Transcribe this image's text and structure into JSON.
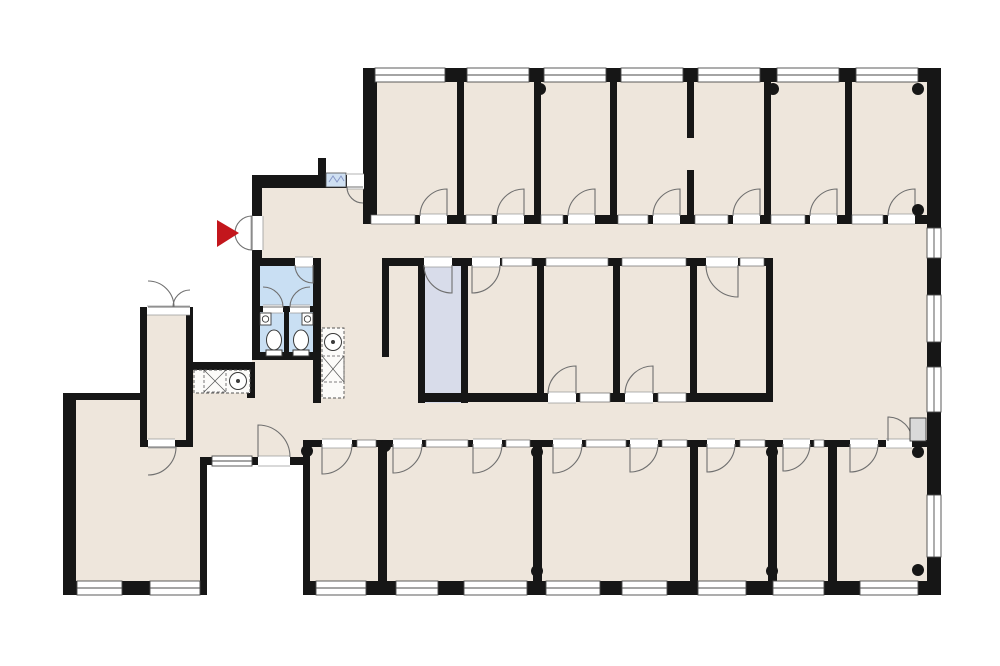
{
  "meta": {
    "description": "office-building-floor-plan",
    "canvas": {
      "w": 1000,
      "h": 666
    }
  },
  "palette": {
    "background": "#ffffff",
    "wall": "#161616",
    "room": "#EEE6DC",
    "bathroom": "#C9DFF3",
    "storage": "#D8DCEA",
    "entry_arrow": "#C3161C",
    "window_frame": "#4a4a4a",
    "interior_glass": "#6a6a6a",
    "threshold_line": "#9a9a9a",
    "door_line": "#6f6f6f",
    "fixture_line": "#3a3a3a",
    "fixture_fill": "#ffffff",
    "counter_line": "#555555",
    "mat_fill": "#d9d9d9",
    "glass_block_fill": "#cfe0f2",
    "glass_block_line": "#8898c8"
  },
  "floors": [
    {
      "name": "floor-top-rooms",
      "fill": "room",
      "rect": [
        363,
        68,
        564,
        198
      ]
    },
    {
      "name": "floor-entry-hall",
      "fill": "room",
      "rect": [
        252,
        175,
        125,
        265
      ]
    },
    {
      "name": "floor-corridor",
      "fill": "room",
      "rect": [
        377,
        228,
        550,
        212
      ]
    },
    {
      "name": "floor-left-lobby",
      "fill": "room",
      "rect": [
        193,
        362,
        117,
        95
      ]
    },
    {
      "name": "floor-kitchen",
      "fill": "room",
      "rect": [
        140,
        307,
        53,
        140
      ]
    },
    {
      "name": "floor-big-room",
      "fill": "room",
      "rect": [
        63,
        393,
        144,
        202
      ]
    },
    {
      "name": "floor-bottom-rooms",
      "fill": "room",
      "rect": [
        303,
        440,
        638,
        155
      ]
    },
    {
      "name": "floor-bathroom",
      "fill": "bathroom",
      "rect": [
        252,
        258,
        68,
        102
      ]
    },
    {
      "name": "floor-storage",
      "fill": "storage",
      "rect": [
        418,
        262,
        50,
        141
      ]
    }
  ],
  "walls": [
    [
      363,
      68,
      578,
      14
    ],
    [
      927,
      68,
      14,
      527
    ],
    [
      363,
      82,
      14,
      133
    ],
    [
      363,
      215,
      564,
      9
    ],
    [
      457,
      82,
      7,
      133
    ],
    [
      534,
      82,
      7,
      133
    ],
    [
      610,
      82,
      7,
      133
    ],
    [
      687,
      82,
      7,
      56
    ],
    [
      687,
      170,
      7,
      45
    ],
    [
      764,
      82,
      7,
      133
    ],
    [
      845,
      82,
      7,
      133
    ],
    [
      252,
      175,
      125,
      13
    ],
    [
      318,
      158,
      8,
      17
    ],
    [
      252,
      175,
      10,
      87
    ],
    [
      252,
      258,
      68,
      8
    ],
    [
      313,
      258,
      8,
      145
    ],
    [
      252,
      352,
      69,
      8
    ],
    [
      252,
      262,
      8,
      98
    ],
    [
      260,
      306,
      53,
      6
    ],
    [
      284,
      312,
      5,
      40
    ],
    [
      382,
      258,
      391,
      8
    ],
    [
      382,
      262,
      7,
      95
    ],
    [
      418,
      262,
      7,
      141
    ],
    [
      461,
      262,
      7,
      141
    ],
    [
      537,
      266,
      7,
      127
    ],
    [
      613,
      266,
      7,
      127
    ],
    [
      690,
      266,
      7,
      127
    ],
    [
      766,
      262,
      7,
      140
    ],
    [
      418,
      393,
      355,
      9
    ],
    [
      140,
      307,
      53,
      7
    ],
    [
      140,
      307,
      7,
      140
    ],
    [
      186,
      307,
      7,
      140
    ],
    [
      140,
      440,
      53,
      7
    ],
    [
      193,
      362,
      62,
      8
    ],
    [
      247,
      370,
      8,
      28
    ],
    [
      63,
      393,
      84,
      7
    ],
    [
      63,
      393,
      13,
      202
    ],
    [
      200,
      457,
      7,
      124
    ],
    [
      200,
      457,
      110,
      8
    ],
    [
      303,
      440,
      7,
      141
    ],
    [
      303,
      440,
      624,
      7
    ],
    [
      378,
      447,
      9,
      134
    ],
    [
      533,
      447,
      9,
      134
    ],
    [
      690,
      447,
      8,
      134
    ],
    [
      768,
      447,
      9,
      134
    ],
    [
      828,
      447,
      9,
      134
    ],
    [
      303,
      581,
      638,
      14
    ],
    [
      63,
      581,
      144,
      14
    ]
  ],
  "exterior_windows": [
    [
      375,
      68,
      70,
      14
    ],
    [
      467,
      68,
      62,
      14
    ],
    [
      544,
      68,
      62,
      14
    ],
    [
      621,
      68,
      62,
      14
    ],
    [
      698,
      68,
      62,
      14
    ],
    [
      777,
      68,
      62,
      14
    ],
    [
      856,
      68,
      62,
      14
    ],
    [
      927,
      228,
      14,
      30
    ],
    [
      927,
      295,
      14,
      47
    ],
    [
      927,
      367,
      14,
      45
    ],
    [
      927,
      495,
      14,
      62
    ],
    [
      316,
      581,
      50,
      14
    ],
    [
      396,
      581,
      42,
      14
    ],
    [
      464,
      581,
      63,
      14
    ],
    [
      546,
      581,
      54,
      14
    ],
    [
      622,
      581,
      45,
      14
    ],
    [
      698,
      581,
      48,
      14
    ],
    [
      773,
      581,
      51,
      14
    ],
    [
      860,
      581,
      58,
      14
    ],
    [
      77,
      581,
      45,
      14
    ],
    [
      150,
      581,
      50,
      14
    ],
    [
      212,
      456,
      40,
      10
    ]
  ],
  "interior_windows": [
    [
      371,
      215,
      44,
      9
    ],
    [
      466,
      215,
      26,
      9
    ],
    [
      541,
      215,
      22,
      9
    ],
    [
      618,
      215,
      30,
      9
    ],
    [
      695,
      215,
      33,
      9
    ],
    [
      771,
      215,
      34,
      9
    ],
    [
      852,
      215,
      31,
      9
    ],
    [
      502,
      258,
      30,
      8
    ],
    [
      546,
      258,
      62,
      8
    ],
    [
      622,
      258,
      64,
      8
    ],
    [
      740,
      258,
      24,
      8
    ],
    [
      580,
      393,
      30,
      9
    ],
    [
      658,
      393,
      28,
      9
    ],
    [
      357,
      440,
      19,
      7
    ],
    [
      426,
      440,
      42,
      7
    ],
    [
      506,
      440,
      24,
      7
    ],
    [
      586,
      440,
      40,
      7
    ],
    [
      662,
      440,
      25,
      7
    ],
    [
      740,
      440,
      25,
      7
    ],
    [
      814,
      440,
      10,
      7
    ]
  ],
  "thresholds": [
    [
      420,
      214,
      27,
      10
    ],
    [
      497,
      214,
      27,
      10
    ],
    [
      568,
      214,
      27,
      10
    ],
    [
      653,
      214,
      27,
      10
    ],
    [
      733,
      214,
      27,
      10
    ],
    [
      810,
      214,
      27,
      10
    ],
    [
      888,
      214,
      27,
      10
    ],
    [
      424,
      257,
      28,
      10
    ],
    [
      472,
      257,
      28,
      10
    ],
    [
      706,
      257,
      32,
      10
    ],
    [
      548,
      392,
      28,
      11
    ],
    [
      625,
      392,
      28,
      11
    ],
    [
      295,
      257,
      18,
      10
    ],
    [
      263,
      305,
      20,
      8
    ],
    [
      290,
      305,
      20,
      8
    ],
    [
      251,
      216,
      12,
      34
    ],
    [
      347,
      174,
      17,
      15
    ],
    [
      147,
      306,
      43,
      9
    ],
    [
      148,
      439,
      27,
      9
    ],
    [
      258,
      456,
      32,
      10
    ],
    [
      322,
      439,
      30,
      9
    ],
    [
      393,
      439,
      29,
      9
    ],
    [
      473,
      439,
      29,
      9
    ],
    [
      553,
      439,
      29,
      9
    ],
    [
      630,
      439,
      28,
      9
    ],
    [
      707,
      439,
      28,
      9
    ],
    [
      783,
      439,
      27,
      9
    ],
    [
      850,
      439,
      28,
      9
    ],
    [
      886,
      439,
      26,
      9
    ]
  ],
  "doors": [
    {
      "name": "door-top-room-1",
      "d": "M447,216 L447,189 A27,27 0 0 0 420,216"
    },
    {
      "name": "door-top-room-2",
      "d": "M524,216 L524,189 A27,27 0 0 0 497,216"
    },
    {
      "name": "door-top-room-3",
      "d": "M595,216 L595,189 A27,27 0 0 0 568,216"
    },
    {
      "name": "door-top-room-4",
      "d": "M680,216 L680,189 A27,27 0 0 0 653,216"
    },
    {
      "name": "door-top-room-5",
      "d": "M760,216 L760,189 A27,27 0 0 0 733,216"
    },
    {
      "name": "door-top-room-6",
      "d": "M837,216 L837,189 A27,27 0 0 0 810,216"
    },
    {
      "name": "door-top-room-7",
      "d": "M915,216 L915,189 A27,27 0 0 0 888,216"
    },
    {
      "name": "door-storage",
      "d": "M452,265 L452,293 A28,28 0 0 1 424,265"
    },
    {
      "name": "door-mid-room-1",
      "d": "M472,265 L472,293 A28,28 0 0 0 500,265"
    },
    {
      "name": "door-mid-room-4",
      "d": "M738,265 L738,297 A32,32 0 0 1 706,265"
    },
    {
      "name": "door-mid-room-2",
      "d": "M576,394 L576,366 A28,28 0 0 0 548,394"
    },
    {
      "name": "door-mid-room-3",
      "d": "M653,394 L653,366 A28,28 0 0 0 625,394"
    },
    {
      "name": "door-wc-lobby",
      "d": "M313,265 L313,283 A18,18 0 0 1 295,265"
    },
    {
      "name": "door-wc-stall-left",
      "d": "M263,307 L283,307 A20,20 0 0 0 263,287"
    },
    {
      "name": "door-wc-stall-right",
      "d": "M310,307 L290,307 A20,20 0 0 1 310,287"
    },
    {
      "name": "door-entrance-upper",
      "d": "M252,233 L252,216 A17,17 0 0 0 235,233"
    },
    {
      "name": "door-entrance-lower",
      "d": "M252,233 L252,250 A17,17 0 0 1 235,233"
    },
    {
      "name": "door-vestibule",
      "d": "M363,187 L347,187 A16,16 0 0 0 363,203"
    },
    {
      "name": "door-kitchen-north-a",
      "d": "M148,307 L174,307 A26,26 0 0 0 148,281"
    },
    {
      "name": "door-kitchen-north-b",
      "d": "M190,307 L173,307 A17,17 0 0 1 190,290"
    },
    {
      "name": "door-kitchen-south",
      "d": "M148,447 L176,447 A28,28 0 0 1 148,475"
    },
    {
      "name": "door-lobby-south",
      "d": "M258,457 L258,425 A32,32 0 0 1 290,457"
    },
    {
      "name": "door-exit-east",
      "d": "M888,441 L888,417 A24,24 0 0 1 912,441"
    },
    {
      "name": "door-bottom-room-1",
      "d": "M322,444 L322,474 A30,30 0 0 0 352,444"
    },
    {
      "name": "door-bottom-room-2a",
      "d": "M393,444 L393,473 A29,29 0 0 0 422,444"
    },
    {
      "name": "door-bottom-room-2b",
      "d": "M473,444 L473,473 A29,29 0 0 0 502,444"
    },
    {
      "name": "door-bottom-room-3a",
      "d": "M553,444 L553,473 A29,29 0 0 0 582,444"
    },
    {
      "name": "door-bottom-room-3b",
      "d": "M630,444 L630,472 A28,28 0 0 0 658,444"
    },
    {
      "name": "door-bottom-room-4",
      "d": "M707,444 L707,472 A28,28 0 0 0 735,444"
    },
    {
      "name": "door-bottom-room-5",
      "d": "M783,444 L783,471 A27,27 0 0 0 810,444"
    },
    {
      "name": "door-bottom-room-6",
      "d": "M850,444 L850,472 A28,28 0 0 0 878,444"
    }
  ],
  "columns": [
    [
      540,
      89
    ],
    [
      773,
      89
    ],
    [
      918,
      89
    ],
    [
      918,
      210
    ],
    [
      70,
      449
    ],
    [
      70,
      571
    ],
    [
      307,
      451
    ],
    [
      385,
      446
    ],
    [
      537,
      452
    ],
    [
      537,
      571
    ],
    [
      772,
      452
    ],
    [
      772,
      571
    ],
    [
      918,
      452
    ],
    [
      918,
      570
    ]
  ],
  "fixtures": {
    "entry_arrow": {
      "points": "217,220 217,247 239,233"
    },
    "glass_block": {
      "rect": [
        326,
        173,
        20,
        14
      ],
      "zigzag": "329,182 333,176 337,182 341,176 344,181"
    },
    "toilets": [
      {
        "bowl": [
          274,
          340,
          7.5,
          10
        ],
        "tank": [
          266,
          350,
          16,
          6
        ]
      },
      {
        "bowl": [
          301,
          340,
          7.5,
          10
        ],
        "tank": [
          293,
          350,
          16,
          6
        ]
      }
    ],
    "stall_sinks": [
      [
        260,
        313,
        11,
        12
      ],
      [
        302,
        313,
        11,
        12
      ]
    ],
    "counters": [
      {
        "name": "counter-tea-point",
        "rect": [
          322,
          328,
          22,
          70
        ],
        "hatch": [
          322,
          356,
          22,
          26
        ],
        "sink": [
          333,
          342,
          8.5
        ]
      },
      {
        "name": "counter-kitchen",
        "rect": [
          194,
          370,
          56,
          23
        ],
        "hatch": [
          204,
          370,
          22,
          22
        ],
        "sink": [
          238,
          381,
          8.5
        ]
      }
    ],
    "exit_mat": [
      910,
      418,
      16,
      23
    ]
  }
}
